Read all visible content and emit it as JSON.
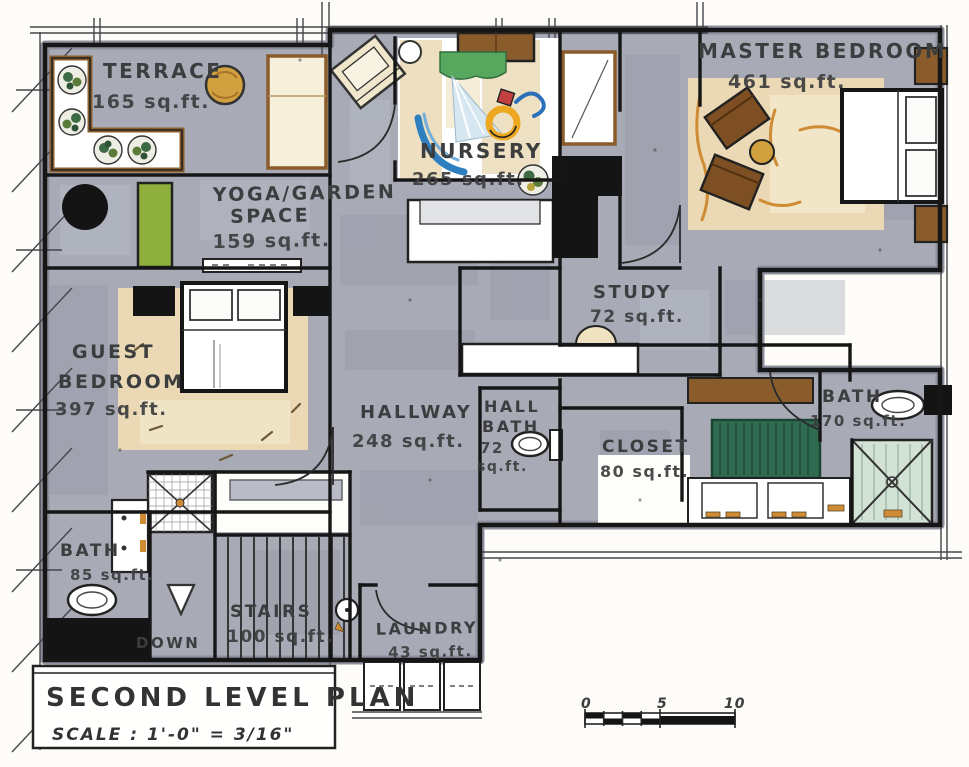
{
  "title_block": {
    "title": "SECOND LEVEL PLAN",
    "scale_label": "SCALE : 1'-0\" = 3/16\""
  },
  "rooms": {
    "terrace": {
      "name": "TERRACE",
      "area": "165 sq.ft."
    },
    "yoga": {
      "name": "YOGA/GARDEN",
      "name2": "SPACE",
      "area": "159 sq.ft."
    },
    "nursery": {
      "name": "NURSERY",
      "area": "265 sq.ft."
    },
    "master_bedroom": {
      "name": "MASTER BEDROOM",
      "area": "461 sq.ft."
    },
    "study": {
      "name": "STUDY",
      "area": "72 sq.ft."
    },
    "guest_bedroom": {
      "name": "GUEST",
      "name2": "BEDROOM",
      "area": "397 sq.ft."
    },
    "hallway": {
      "name": "HALLWAY",
      "area": "248 sq.ft."
    },
    "hall_bath": {
      "name": "HALL",
      "name2": "BATH",
      "area": "72",
      "area2": "sq.ft."
    },
    "closet": {
      "name": "CLOSET",
      "area": "80 sq.ft."
    },
    "master_bath": {
      "name": "BATH",
      "area": "170 sq.ft."
    },
    "guest_bath": {
      "name": "BATH",
      "area": "85 sq.ft."
    },
    "stairs": {
      "name": "STAIRS",
      "area": "100 sq.ft.",
      "direction": "DOWN"
    },
    "laundry": {
      "name": "LAUNDRY",
      "area": "43 sq.ft."
    }
  },
  "scale_bar": {
    "ticks": [
      "0",
      "5",
      "10"
    ]
  },
  "colors": {
    "floor_gray": "#a8abb6",
    "rug_tan": "#e9d8b0",
    "wood_brown": "#8a5c2c",
    "table_gold": "#d2a13f",
    "yoga_mat_green": "#8fb03c",
    "closet_rug_green": "#2e6b50",
    "shower_green": "#d2e2d4",
    "toy_blue": "#2e7fc0",
    "toy_yellow": "#eda821",
    "toy_red": "#c24040",
    "ink": "#1c1c1c"
  }
}
